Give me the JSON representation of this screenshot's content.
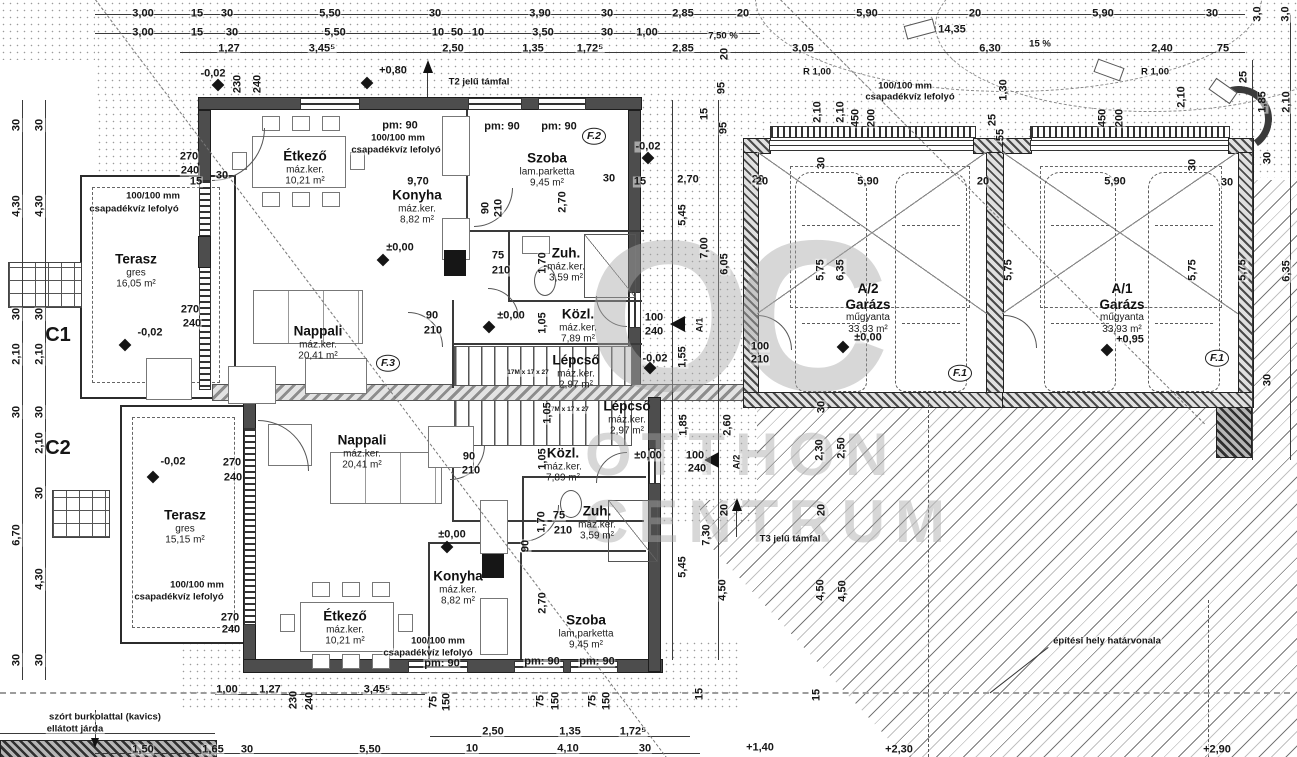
{
  "watermark": {
    "logo": "OC",
    "line1": "OTTHON",
    "line2": "CENTRUM"
  },
  "rooms": [
    {
      "n": "Étkező",
      "f": "máz.ker.",
      "a": "10,21 m²",
      "x": 305,
      "y": 168
    },
    {
      "n": "Konyha",
      "f": "máz.ker.",
      "a": "8,82 m²",
      "x": 417,
      "y": 207
    },
    {
      "n": "Szoba",
      "f": "lam.parketta",
      "a": "9,45 m²",
      "x": 547,
      "y": 170
    },
    {
      "n": "Terasz",
      "f": "gres",
      "a": "16,05 m²",
      "x": 136,
      "y": 271
    },
    {
      "n": "Nappali",
      "f": "máz.ker.",
      "a": "20,41 m²",
      "x": 318,
      "y": 343
    },
    {
      "n": "Zuh.",
      "f": "máz.ker.",
      "a": "3,59 m²",
      "x": 566,
      "y": 265
    },
    {
      "n": "Közl.",
      "f": "máz.ker.",
      "a": "7,89 m²",
      "x": 578,
      "y": 326
    },
    {
      "n": "Lépcső",
      "f": "máz.ker.",
      "a": "2,97 m²",
      "x": 576,
      "y": 372
    },
    {
      "n": "Lépcső",
      "f": "máz.ker.",
      "a": "2,97 m²",
      "x": 627,
      "y": 418
    },
    {
      "n": "Közl.",
      "f": "máz.ker.",
      "a": "7,89 m²",
      "x": 563,
      "y": 465
    },
    {
      "n": "Zuh.",
      "f": "máz.ker.",
      "a": "3,59 m²",
      "x": 597,
      "y": 523
    },
    {
      "n": "Nappali",
      "f": "máz.ker.",
      "a": "20,41 m²",
      "x": 362,
      "y": 452
    },
    {
      "n": "Terasz",
      "f": "gres",
      "a": "15,15 m²",
      "x": 185,
      "y": 527
    },
    {
      "n": "Konyha",
      "f": "máz.ker.",
      "a": "8,82 m²",
      "x": 458,
      "y": 588
    },
    {
      "n": "Étkező",
      "f": "máz.ker.",
      "a": "10,21 m²",
      "x": 345,
      "y": 628
    },
    {
      "n": "Szoba",
      "f": "lam.parketta",
      "a": "9,45 m²",
      "x": 586,
      "y": 632
    },
    {
      "u": "A/2",
      "n": "Garázs",
      "f": "műgyanta",
      "a": "33,93 m²",
      "x": 868,
      "y": 308
    },
    {
      "u": "A/1",
      "n": "Garázs",
      "f": "műgyanta",
      "a": "33,93 m²",
      "x": 1122,
      "y": 308
    }
  ],
  "labels": [
    {
      "t": "3,00",
      "x": 143,
      "y": 14
    },
    {
      "t": "15",
      "x": 197,
      "y": 14
    },
    {
      "t": "30",
      "x": 227,
      "y": 14
    },
    {
      "t": "5,50",
      "x": 330,
      "y": 14
    },
    {
      "t": "30",
      "x": 435,
      "y": 14
    },
    {
      "t": "3,90",
      "x": 540,
      "y": 14
    },
    {
      "t": "30",
      "x": 607,
      "y": 14
    },
    {
      "t": "2,85",
      "x": 683,
      "y": 14
    },
    {
      "t": "20",
      "x": 743,
      "y": 14
    },
    {
      "t": "5,90",
      "x": 867,
      "y": 14
    },
    {
      "t": "20",
      "x": 975,
      "y": 14
    },
    {
      "t": "5,90",
      "x": 1103,
      "y": 14
    },
    {
      "t": "30",
      "x": 1212,
      "y": 14
    },
    {
      "t": "14,35",
      "x": 952,
      "y": 30
    },
    {
      "t": "3,00",
      "x": 143,
      "y": 33
    },
    {
      "t": "15",
      "x": 197,
      "y": 33
    },
    {
      "t": "30",
      "x": 232,
      "y": 33
    },
    {
      "t": "5,50",
      "x": 335,
      "y": 33
    },
    {
      "t": "10",
      "x": 438,
      "y": 33
    },
    {
      "t": "50",
      "x": 457,
      "y": 33
    },
    {
      "t": "10",
      "x": 478,
      "y": 33
    },
    {
      "t": "3,50",
      "x": 543,
      "y": 33
    },
    {
      "t": "30",
      "x": 607,
      "y": 33
    },
    {
      "t": "1,00",
      "x": 647,
      "y": 33
    },
    {
      "t": "7,50 %",
      "x": 723,
      "y": 36,
      "c": "ann"
    },
    {
      "t": "1,27",
      "x": 229,
      "y": 49
    },
    {
      "t": "3,45⁵",
      "x": 322,
      "y": 49
    },
    {
      "t": "2,50",
      "x": 453,
      "y": 49
    },
    {
      "t": "1,35",
      "x": 533,
      "y": 49
    },
    {
      "t": "1,72⁵",
      "x": 590,
      "y": 49
    },
    {
      "t": "2,85",
      "x": 683,
      "y": 49
    },
    {
      "t": "20",
      "x": 725,
      "y": 54,
      "r": -90
    },
    {
      "t": "3,05",
      "x": 803,
      "y": 49
    },
    {
      "t": "6,30",
      "x": 990,
      "y": 49
    },
    {
      "t": "15 %",
      "x": 1040,
      "y": 44,
      "c": "ann"
    },
    {
      "t": "2,40",
      "x": 1162,
      "y": 49
    },
    {
      "t": "75",
      "x": 1223,
      "y": 49
    },
    {
      "t": "3,0",
      "x": 1258,
      "y": 14,
      "r": -90
    },
    {
      "t": "3,0",
      "x": 1286,
      "y": 14,
      "r": -90
    },
    {
      "t": "R 1,00",
      "x": 817,
      "y": 72,
      "c": "ann"
    },
    {
      "t": "R 1,00",
      "x": 1155,
      "y": 72,
      "c": "ann"
    },
    {
      "t": "100/100 mm",
      "x": 905,
      "y": 86,
      "c": "ann"
    },
    {
      "t": "csapadékvíz lefolyó",
      "x": 910,
      "y": 97,
      "c": "ann"
    },
    {
      "t": "2,10",
      "x": 818,
      "y": 112,
      "r": -90
    },
    {
      "t": "2,10",
      "x": 841,
      "y": 112,
      "r": -90
    },
    {
      "t": "450",
      "x": 856,
      "y": 118,
      "r": -90
    },
    {
      "t": "200",
      "x": 872,
      "y": 118,
      "r": -90
    },
    {
      "t": "1,30",
      "x": 1004,
      "y": 90,
      "r": -90
    },
    {
      "t": "25",
      "x": 993,
      "y": 120,
      "r": -90
    },
    {
      "t": "55",
      "x": 1001,
      "y": 135,
      "r": -90
    },
    {
      "t": "450",
      "x": 1103,
      "y": 118,
      "r": -90
    },
    {
      "t": "200",
      "x": 1120,
      "y": 118,
      "r": -90
    },
    {
      "t": "2,10",
      "x": 1182,
      "y": 97,
      "r": -90
    },
    {
      "t": "25",
      "x": 1244,
      "y": 77,
      "r": -90
    },
    {
      "t": "1,85",
      "x": 1263,
      "y": 102,
      "r": -90
    },
    {
      "t": "2,10",
      "x": 1287,
      "y": 102,
      "r": -90
    },
    {
      "t": "30",
      "x": 1268,
      "y": 158,
      "r": -90
    },
    {
      "t": "5,75",
      "x": 1243,
      "y": 270,
      "r": -90
    },
    {
      "t": "6,35",
      "x": 1287,
      "y": 271,
      "r": -90
    },
    {
      "t": "30",
      "x": 1268,
      "y": 380,
      "r": -90
    },
    {
      "t": "-0,02",
      "x": 213,
      "y": 74
    },
    {
      "t": "230",
      "x": 238,
      "y": 84,
      "r": -90
    },
    {
      "t": "240",
      "x": 258,
      "y": 84,
      "r": -90
    },
    {
      "t": "+0,80",
      "x": 393,
      "y": 71
    },
    {
      "t": "T2 jelű támfal",
      "x": 479,
      "y": 82,
      "c": "ann"
    },
    {
      "t": "95",
      "x": 722,
      "y": 88,
      "r": -90
    },
    {
      "t": "15",
      "x": 705,
      "y": 114,
      "r": -90
    },
    {
      "t": "95",
      "x": 724,
      "y": 128,
      "r": -90
    },
    {
      "t": "pm: 90",
      "x": 400,
      "y": 126
    },
    {
      "t": "100/100 mm",
      "x": 398,
      "y": 138,
      "c": "ann"
    },
    {
      "t": "csapadékvíz lefolyó",
      "x": 396,
      "y": 150,
      "c": "ann"
    },
    {
      "t": "pm: 90",
      "x": 502,
      "y": 127
    },
    {
      "t": "pm: 90",
      "x": 559,
      "y": 127
    },
    {
      "t": "270",
      "x": 189,
      "y": 157
    },
    {
      "t": "240",
      "x": 190,
      "y": 171
    },
    {
      "t": "30",
      "x": 222,
      "y": 176
    },
    {
      "t": "15",
      "x": 196,
      "y": 182
    },
    {
      "t": "100/100 mm",
      "x": 153,
      "y": 196,
      "c": "ann"
    },
    {
      "t": "csapadékvíz lefolyó",
      "x": 134,
      "y": 209,
      "c": "ann"
    },
    {
      "t": "9,70",
      "x": 418,
      "y": 182
    },
    {
      "t": "30",
      "x": 609,
      "y": 179
    },
    {
      "t": "90",
      "x": 486,
      "y": 208,
      "r": -90
    },
    {
      "t": "210",
      "x": 499,
      "y": 208,
      "r": -90
    },
    {
      "t": "2,70",
      "x": 563,
      "y": 202,
      "r": -90
    },
    {
      "t": "75",
      "x": 498,
      "y": 256
    },
    {
      "t": "210",
      "x": 501,
      "y": 271
    },
    {
      "t": "1,70",
      "x": 543,
      "y": 263,
      "r": -90
    },
    {
      "t": "270",
      "x": 190,
      "y": 310
    },
    {
      "t": "240",
      "x": 192,
      "y": 324
    },
    {
      "t": "-0,02",
      "x": 150,
      "y": 333
    },
    {
      "t": "90",
      "x": 432,
      "y": 316
    },
    {
      "t": "210",
      "x": 433,
      "y": 331
    },
    {
      "t": "±0,00",
      "x": 511,
      "y": 316
    },
    {
      "t": "1,05",
      "x": 543,
      "y": 323,
      "r": -90
    },
    {
      "t": "±0,00",
      "x": 400,
      "y": 248
    },
    {
      "t": "100",
      "x": 654,
      "y": 318
    },
    {
      "t": "240",
      "x": 654,
      "y": 332
    },
    {
      "t": "-0,02",
      "x": 648,
      "y": 147
    },
    {
      "t": "15",
      "x": 640,
      "y": 182
    },
    {
      "t": "2,70",
      "x": 688,
      "y": 180
    },
    {
      "t": "20",
      "x": 758,
      "y": 180
    },
    {
      "t": "5,45",
      "x": 683,
      "y": 215,
      "r": -90
    },
    {
      "t": "7,00",
      "x": 705,
      "y": 248,
      "r": -90
    },
    {
      "t": "6,05",
      "x": 725,
      "y": 264,
      "r": -90
    },
    {
      "t": "1,55",
      "x": 683,
      "y": 357,
      "r": -90
    },
    {
      "t": "-0,02",
      "x": 655,
      "y": 359
    },
    {
      "t": "100",
      "x": 760,
      "y": 347
    },
    {
      "t": "210",
      "x": 760,
      "y": 360
    },
    {
      "t": "17M x 17 x 27",
      "x": 528,
      "y": 373,
      "c": "tiny"
    },
    {
      "t": "17M x 17 x 27",
      "x": 568,
      "y": 410,
      "c": "tiny"
    },
    {
      "t": "1,85",
      "x": 684,
      "y": 425,
      "r": -90
    },
    {
      "t": "2,60",
      "x": 728,
      "y": 425,
      "r": -90
    },
    {
      "t": "100",
      "x": 695,
      "y": 456
    },
    {
      "t": "240",
      "x": 697,
      "y": 469
    },
    {
      "t": "±0,00",
      "x": 648,
      "y": 456
    },
    {
      "t": "1,05",
      "x": 548,
      "y": 413,
      "r": -90
    },
    {
      "t": "1,05",
      "x": 543,
      "y": 459,
      "r": -90
    },
    {
      "t": "90",
      "x": 469,
      "y": 457
    },
    {
      "t": "210",
      "x": 471,
      "y": 471
    },
    {
      "t": "A/1",
      "x": 700,
      "y": 325,
      "r": -90,
      "c": "ann"
    },
    {
      "t": "A/2",
      "x": 737,
      "y": 462,
      "r": -90,
      "c": "ann"
    },
    {
      "t": "270",
      "x": 232,
      "y": 463
    },
    {
      "t": "240",
      "x": 233,
      "y": 478
    },
    {
      "t": "-0,02",
      "x": 173,
      "y": 462
    },
    {
      "t": "±0,00",
      "x": 452,
      "y": 535
    },
    {
      "t": "75",
      "x": 559,
      "y": 516
    },
    {
      "t": "210",
      "x": 563,
      "y": 531
    },
    {
      "t": "1,70",
      "x": 542,
      "y": 522,
      "r": -90
    },
    {
      "t": "90",
      "x": 526,
      "y": 546,
      "r": -90
    },
    {
      "t": "2,70",
      "x": 543,
      "y": 603,
      "r": -90
    },
    {
      "t": "100/100 mm",
      "x": 197,
      "y": 585,
      "c": "ann"
    },
    {
      "t": "csapadékvíz lefolyó",
      "x": 179,
      "y": 597,
      "c": "ann"
    },
    {
      "t": "270",
      "x": 230,
      "y": 618
    },
    {
      "t": "240",
      "x": 231,
      "y": 630
    },
    {
      "t": "100/100 mm",
      "x": 438,
      "y": 641,
      "c": "ann"
    },
    {
      "t": "csapadékvíz lefolyó",
      "x": 428,
      "y": 653,
      "c": "ann"
    },
    {
      "t": "pm: 90",
      "x": 442,
      "y": 664
    },
    {
      "t": "pm: 90",
      "x": 542,
      "y": 662
    },
    {
      "t": "pm: 90",
      "x": 597,
      "y": 662
    },
    {
      "t": "30",
      "x": 822,
      "y": 407,
      "r": -90
    },
    {
      "t": "2,30",
      "x": 820,
      "y": 450,
      "r": -90
    },
    {
      "t": "2,50",
      "x": 842,
      "y": 448,
      "r": -90
    },
    {
      "t": "20",
      "x": 725,
      "y": 510,
      "r": -90
    },
    {
      "t": "20",
      "x": 822,
      "y": 510,
      "r": -90
    },
    {
      "t": "7,30",
      "x": 707,
      "y": 535,
      "r": -90
    },
    {
      "t": "5,45",
      "x": 683,
      "y": 567,
      "r": -90
    },
    {
      "t": "4,50",
      "x": 723,
      "y": 590,
      "r": -90
    },
    {
      "t": "4,50",
      "x": 821,
      "y": 590,
      "r": -90
    },
    {
      "t": "4,50",
      "x": 843,
      "y": 591,
      "r": -90
    },
    {
      "t": "T3 jelű támfal",
      "x": 790,
      "y": 539,
      "c": "ann"
    },
    {
      "t": "építési hely határvonala",
      "x": 1107,
      "y": 641,
      "c": "ann"
    },
    {
      "t": "30",
      "x": 822,
      "y": 163,
      "r": -90
    },
    {
      "t": "20",
      "x": 762,
      "y": 182
    },
    {
      "t": "5,90",
      "x": 868,
      "y": 182
    },
    {
      "t": "20",
      "x": 983,
      "y": 182
    },
    {
      "t": "5,75",
      "x": 821,
      "y": 270,
      "r": -90
    },
    {
      "t": "6,35",
      "x": 841,
      "y": 270,
      "r": -90
    },
    {
      "t": "5,75",
      "x": 1009,
      "y": 270,
      "r": -90
    },
    {
      "t": "30",
      "x": 1193,
      "y": 165,
      "r": -90
    },
    {
      "t": "5,90",
      "x": 1115,
      "y": 182
    },
    {
      "t": "30",
      "x": 1227,
      "y": 183
    },
    {
      "t": "5,75",
      "x": 1193,
      "y": 270,
      "r": -90
    },
    {
      "t": "30",
      "x": 17,
      "y": 125,
      "r": -90
    },
    {
      "t": "30",
      "x": 40,
      "y": 125,
      "r": -90
    },
    {
      "t": "4,30",
      "x": 17,
      "y": 206,
      "r": -90
    },
    {
      "t": "4,30",
      "x": 40,
      "y": 206,
      "r": -90
    },
    {
      "t": "30",
      "x": 17,
      "y": 314,
      "r": -90
    },
    {
      "t": "30",
      "x": 40,
      "y": 314,
      "r": -90
    },
    {
      "t": "2,10",
      "x": 17,
      "y": 354,
      "r": -90
    },
    {
      "t": "2,10",
      "x": 40,
      "y": 354,
      "r": -90
    },
    {
      "t": "30",
      "x": 17,
      "y": 412,
      "r": -90
    },
    {
      "t": "30",
      "x": 40,
      "y": 412,
      "r": -90
    },
    {
      "t": "2,10",
      "x": 40,
      "y": 443,
      "r": -90
    },
    {
      "t": "30",
      "x": 40,
      "y": 493,
      "r": -90
    },
    {
      "t": "6,70",
      "x": 17,
      "y": 535,
      "r": -90
    },
    {
      "t": "4,30",
      "x": 40,
      "y": 579,
      "r": -90
    },
    {
      "t": "30",
      "x": 17,
      "y": 660,
      "r": -90
    },
    {
      "t": "30",
      "x": 40,
      "y": 660,
      "r": -90
    },
    {
      "t": "C1",
      "x": 58,
      "y": 335,
      "c": "big"
    },
    {
      "t": "C2",
      "x": 58,
      "y": 448,
      "c": "big"
    },
    {
      "t": "szórt burkolattal (kavics)",
      "x": 105,
      "y": 717,
      "c": "ann"
    },
    {
      "t": "ellátott járda",
      "x": 75,
      "y": 729,
      "c": "ann"
    },
    {
      "t": "230",
      "x": 294,
      "y": 700,
      "r": -90
    },
    {
      "t": "240",
      "x": 310,
      "y": 701,
      "r": -90
    },
    {
      "t": "75",
      "x": 434,
      "y": 702,
      "r": -90
    },
    {
      "t": "150",
      "x": 447,
      "y": 702,
      "r": -90
    },
    {
      "t": "75",
      "x": 541,
      "y": 701,
      "r": -90
    },
    {
      "t": "150",
      "x": 556,
      "y": 701,
      "r": -90
    },
    {
      "t": "75",
      "x": 593,
      "y": 701,
      "r": -90
    },
    {
      "t": "150",
      "x": 607,
      "y": 701,
      "r": -90
    },
    {
      "t": "15",
      "x": 700,
      "y": 694,
      "r": -90
    },
    {
      "t": "15",
      "x": 817,
      "y": 695,
      "r": -90
    },
    {
      "t": "1,00",
      "x": 227,
      "y": 690
    },
    {
      "t": "1,27",
      "x": 270,
      "y": 690
    },
    {
      "t": "3,45⁵",
      "x": 377,
      "y": 690
    },
    {
      "t": "2,50",
      "x": 493,
      "y": 732
    },
    {
      "t": "1,35",
      "x": 570,
      "y": 732
    },
    {
      "t": "1,72⁵",
      "x": 633,
      "y": 732
    },
    {
      "t": "1,50",
      "x": 143,
      "y": 750
    },
    {
      "t": "1,65",
      "x": 213,
      "y": 750
    },
    {
      "t": "30",
      "x": 247,
      "y": 750
    },
    {
      "t": "5,50",
      "x": 370,
      "y": 750
    },
    {
      "t": "10",
      "x": 472,
      "y": 749
    },
    {
      "t": "4,10",
      "x": 568,
      "y": 749
    },
    {
      "t": "30",
      "x": 645,
      "y": 749
    },
    {
      "t": "+1,40",
      "x": 760,
      "y": 748
    },
    {
      "t": "+2,30",
      "x": 899,
      "y": 750
    },
    {
      "t": "+2,90",
      "x": 1217,
      "y": 750
    },
    {
      "t": "F.2",
      "x": 594,
      "y": 136,
      "c": "marker"
    },
    {
      "t": "F.3",
      "x": 388,
      "y": 363,
      "c": "marker"
    },
    {
      "t": "F.1",
      "x": 960,
      "y": 373,
      "c": "marker"
    },
    {
      "t": "F.1",
      "x": 1217,
      "y": 358,
      "c": "marker"
    },
    {
      "t": "",
      "x": 218,
      "y": 85,
      "c": "mk"
    },
    {
      "t": "",
      "x": 367,
      "y": 83,
      "c": "mk"
    },
    {
      "t": "",
      "x": 125,
      "y": 345,
      "c": "mk"
    },
    {
      "t": "",
      "x": 383,
      "y": 260,
      "c": "mk"
    },
    {
      "t": "",
      "x": 489,
      "y": 327,
      "c": "mk"
    },
    {
      "t": "",
      "x": 153,
      "y": 477,
      "c": "mk"
    },
    {
      "t": "",
      "x": 447,
      "y": 547,
      "c": "mk"
    },
    {
      "t": "",
      "x": 843,
      "y": 347,
      "c": "mk"
    },
    {
      "t": "",
      "x": 1107,
      "y": 350,
      "c": "mk"
    },
    {
      "t": "",
      "x": 648,
      "y": 158,
      "c": "mk"
    },
    {
      "t": "",
      "x": 650,
      "y": 368,
      "c": "mk"
    },
    {
      "t": "±0,00",
      "x": 868,
      "y": 338
    },
    {
      "t": "+0,95",
      "x": 1130,
      "y": 340
    }
  ]
}
